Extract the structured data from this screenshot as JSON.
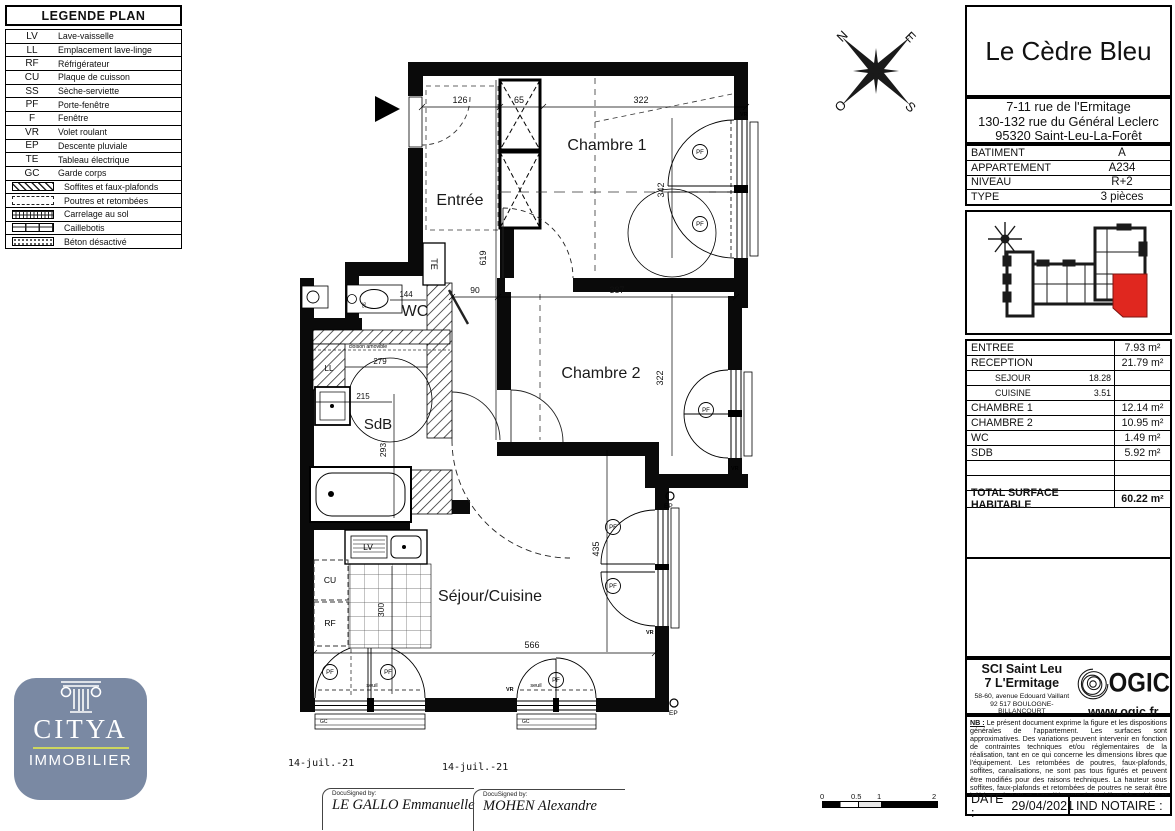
{
  "legend": {
    "title": "LEGENDE PLAN",
    "items": [
      {
        "abbr": "LV",
        "label": "Lave-vaisselle"
      },
      {
        "abbr": "LL",
        "label": "Emplacement lave-linge"
      },
      {
        "abbr": "RF",
        "label": "Réfrigérateur"
      },
      {
        "abbr": "CU",
        "label": "Plaque de cuisson"
      },
      {
        "abbr": "SS",
        "label": "Sèche-serviette"
      },
      {
        "abbr": "PF",
        "label": "Porte-fenêtre"
      },
      {
        "abbr": "F",
        "label": "Fenêtre"
      },
      {
        "abbr": "VR",
        "label": "Volet roulant"
      },
      {
        "abbr": "EP",
        "label": "Descente pluviale"
      },
      {
        "abbr": "TE",
        "label": "Tableau électrique"
      },
      {
        "abbr": "GC",
        "label": "Garde corps"
      }
    ],
    "patterns": [
      {
        "label": "Soffites et faux-plafonds"
      },
      {
        "label": "Poutres et retombées"
      },
      {
        "label": "Carrelage au sol"
      },
      {
        "label": "Caillebotis"
      },
      {
        "label": "Béton désactivé"
      }
    ]
  },
  "titleblock": {
    "residence": "Le Cèdre Bleu",
    "address_line1": "7-11 rue de l'Ermitage",
    "address_line2": "130-132 rue du Général Leclerc",
    "address_line3": "95320 Saint-Leu-La-Forêt",
    "info": [
      {
        "label": "BATIMENT",
        "value": "A"
      },
      {
        "label": "APPARTEMENT",
        "value": "A234"
      },
      {
        "label": "NIVEAU",
        "value": "R+2"
      },
      {
        "label": "TYPE",
        "value": "3 pièces"
      }
    ],
    "surfaces": {
      "rows": [
        {
          "label": "ENTREE",
          "sub": "",
          "value": "7.93 m²"
        },
        {
          "label": "RECEPTION",
          "sub": "",
          "value": "21.79 m²"
        },
        {
          "label": "SEJOUR",
          "sub": "18.28",
          "value": ""
        },
        {
          "label": "CUISINE",
          "sub": "3.51",
          "value": ""
        },
        {
          "label": "CHAMBRE 1",
          "sub": "",
          "value": "12.14 m²"
        },
        {
          "label": "CHAMBRE 2",
          "sub": "",
          "value": "10.95 m²"
        },
        {
          "label": "WC",
          "sub": "",
          "value": "1.49 m²"
        },
        {
          "label": "SDB",
          "sub": "",
          "value": "5.92 m²"
        }
      ],
      "total_label": "TOTAL SURFACE HABITABLE",
      "total_value": "60.22 m²"
    }
  },
  "developer": {
    "name_line1": "SCI Saint Leu",
    "name_line2": "7 L'Ermitage",
    "address1": "58-60, avenue Edouard Vaillant",
    "address2": "92 517 BOULOGNE-BILLANCOURT",
    "address3": "CEDEX",
    "brand": "OGIC",
    "website": "www.ogic.fr"
  },
  "legal": {
    "nb_label": "NB :",
    "nb_text": " Le présent document exprime la figure et les dispositions générales de l'appartement. Les surfaces sont approximatives. Des variations peuvent intervenir en fonction de contraintes techniques et/ou réglementaires de la réalisation, tant en ce qui concerne les dimensions libres que l'équipement. Les retombées de poutres, faux-plafonds, soffites, canalisations, ne sont pas tous figurés et peuvent être modifiés pour des raisons techniques. La hauteur sous soffites, faux-plafonds et retombées de poutres ne serait être inférieure à 2,00 m. Les éléments de mobiliers de cuisine et les implantations des équipements électriques sont présentés à titre indicatif."
  },
  "footer": {
    "date_label": "DATE :",
    "date_value": "29/04/2021",
    "notaire_label": "IND NOTAIRE :"
  },
  "agency": {
    "name": "CITYA",
    "sub": "IMMOBILIER"
  },
  "signatures": {
    "date1": "14-juil.-21",
    "date2": "14-juil.-21",
    "docusign_label": "DocuSigned by:",
    "name1": "LE GALLO Emmanuelle",
    "name2": "MOHEN Alexandre"
  },
  "scalebar": {
    "t0": "0",
    "t05": "0.5",
    "t1": "1",
    "t2": "2"
  },
  "compass": {
    "n": "N",
    "e": "E",
    "o": "O",
    "s": "S"
  },
  "plan": {
    "rooms": {
      "entree": "Entrée",
      "chambre1": "Chambre 1",
      "chambre2": "Chambre 2",
      "wc": "WC",
      "sdb": "SdB",
      "sejour": "Séjour/Cuisine"
    },
    "dims": {
      "d126": "126",
      "d65": "65",
      "d322a": "322",
      "d342": "342",
      "d619": "619",
      "d90": "90",
      "d387": "387",
      "d144": "144",
      "d279": "279",
      "d215": "215",
      "d293": "293",
      "d322b": "322",
      "d300": "300",
      "d566": "566",
      "d435": "435",
      "d96": "96"
    },
    "annotations": {
      "pf": "PF",
      "vr": "VR",
      "ep": "EP",
      "gc": "GC",
      "te": "TE",
      "ll": "LL",
      "cu": "CU",
      "rf": "RF",
      "lv": "LV",
      "seuil": "seuil",
      "cloison": "cloison amovible"
    },
    "colors": {
      "wall": "#0a0a0a",
      "highlight_red": "#e0271f"
    }
  }
}
